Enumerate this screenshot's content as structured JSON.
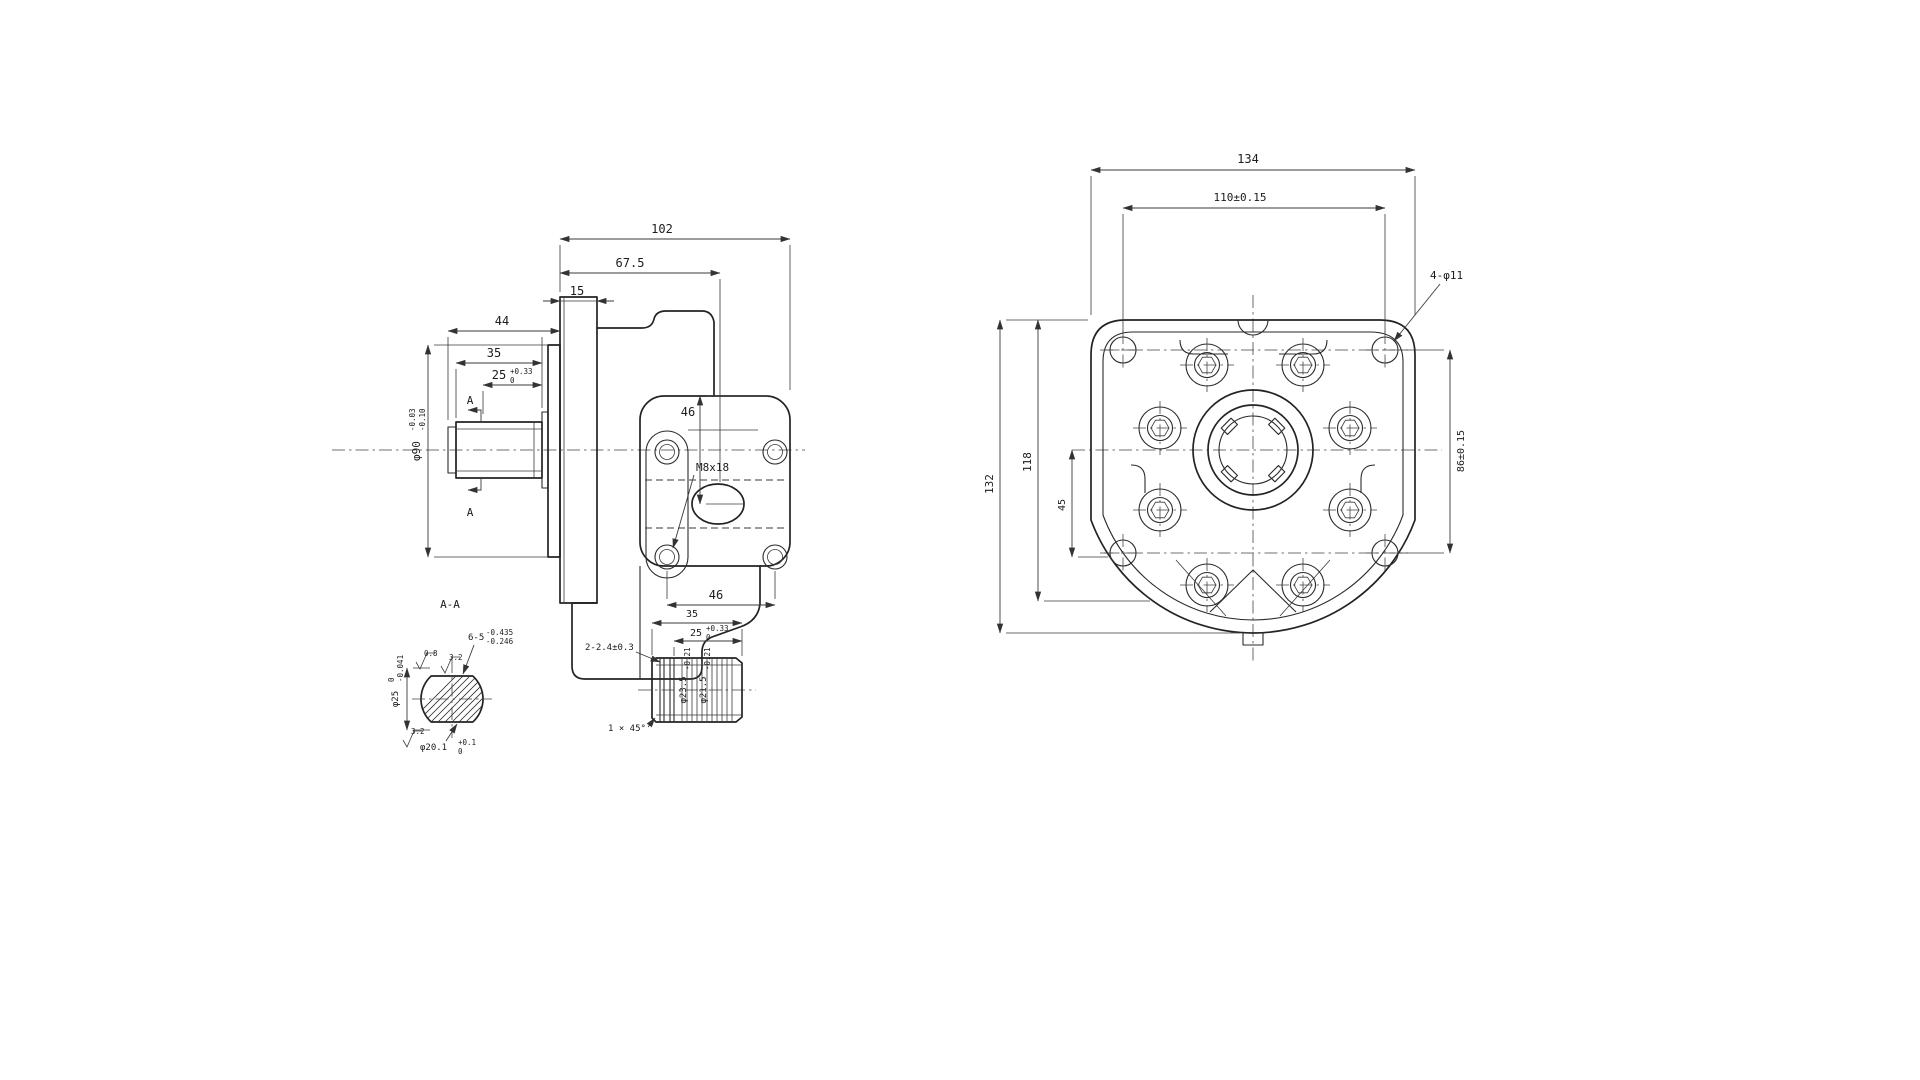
{
  "page": {
    "background": "#ffffff",
    "ink": "#1f1f1f"
  },
  "side_view": {
    "dim_102": "102",
    "dim_67_5": "67.5",
    "dim_15": "15",
    "dim_44": "44",
    "dim_35": "35",
    "dim_25_base": "25",
    "dim_25_sup": "+0.33",
    "dim_25_sub": "0",
    "dia_90_base": "φ90",
    "dia_90_sup": "-0.03",
    "dia_90_sub": "-0.10",
    "dim_46_vertical": "46",
    "dim_46_horizontal": "46",
    "thread_label": "M8x18",
    "section_mark_top": "A",
    "section_mark_bottom": "A"
  },
  "front_view": {
    "dim_134": "134",
    "dim_110": "110±0.15",
    "holes_label": "4-φ11",
    "dim_132": "132",
    "dim_118": "118",
    "dim_45": "45",
    "dim_86": "86±0.15"
  },
  "section_aa": {
    "title": "A-A",
    "spline_base": "6-5",
    "spline_sup": "-0.435",
    "spline_sub": "-0.246",
    "finish_top": "0.8",
    "finish_mid": "3.2",
    "finish_bottom": "3.2",
    "dia_25_base": "φ25",
    "dia_25_sup": "0",
    "dia_25_sub": "-0.041",
    "flat_base": "φ20.1",
    "flat_sup": "+0.1",
    "flat_sub": "0"
  },
  "shaft_detail": {
    "dim_35": "35",
    "dim_25_base": "25",
    "dim_25_sup": "+0.33",
    "dim_25_sub": "0",
    "groove_label": "2-2.4±0.3",
    "dia_major_base": "φ23.5",
    "dia_major_sub": "-0.21",
    "dia_minor_base": "φ21.5",
    "dia_minor_sub": "-0.21",
    "chamfer_label": "1 × 45°"
  }
}
